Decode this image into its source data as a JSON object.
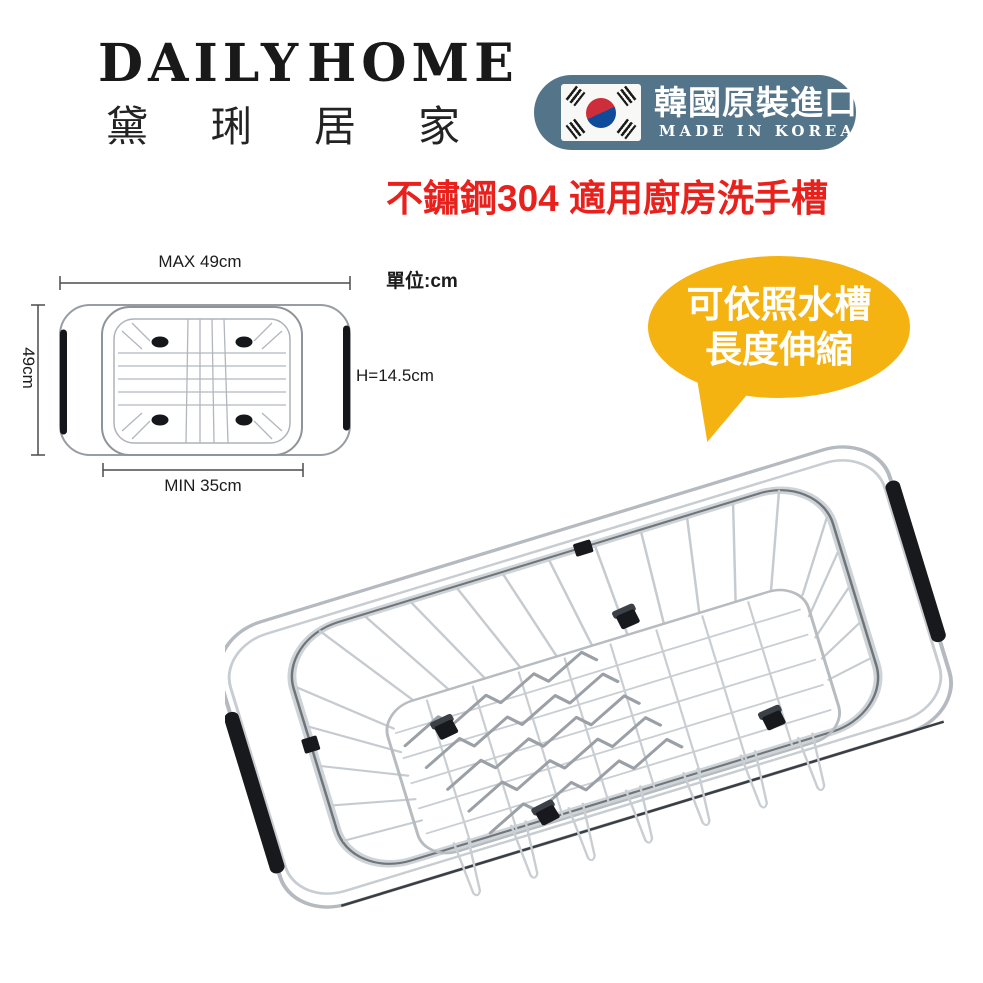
{
  "brand": {
    "name_en_left": "DAILY",
    "name_en_right": "HOME",
    "name_zh": "黛琍居家"
  },
  "origin_badge": {
    "label_zh": "韓國原裝進口",
    "label_en": "MADE IN KOREA",
    "bg_color": "#54748A",
    "flag_red": "#CD2E3A",
    "flag_blue": "#0E4C9B"
  },
  "headline": {
    "text": "不鏽鋼304 適用廚房洗手槽",
    "color": "#E8211D"
  },
  "spec_diagram": {
    "unit_label": "單位:cm",
    "max_width_label": "MAX 49cm",
    "min_width_label": "MIN 35cm",
    "depth_label": "49cm",
    "height_label": "H=14.5cm"
  },
  "callout": {
    "line1": "可依照水槽",
    "line2": "長度伸縮",
    "bg_color": "#F5B312",
    "text_color": "#FFFFFF"
  },
  "product_photo": {
    "subject": "extendable-stainless-steel-sink-drain-basket"
  }
}
